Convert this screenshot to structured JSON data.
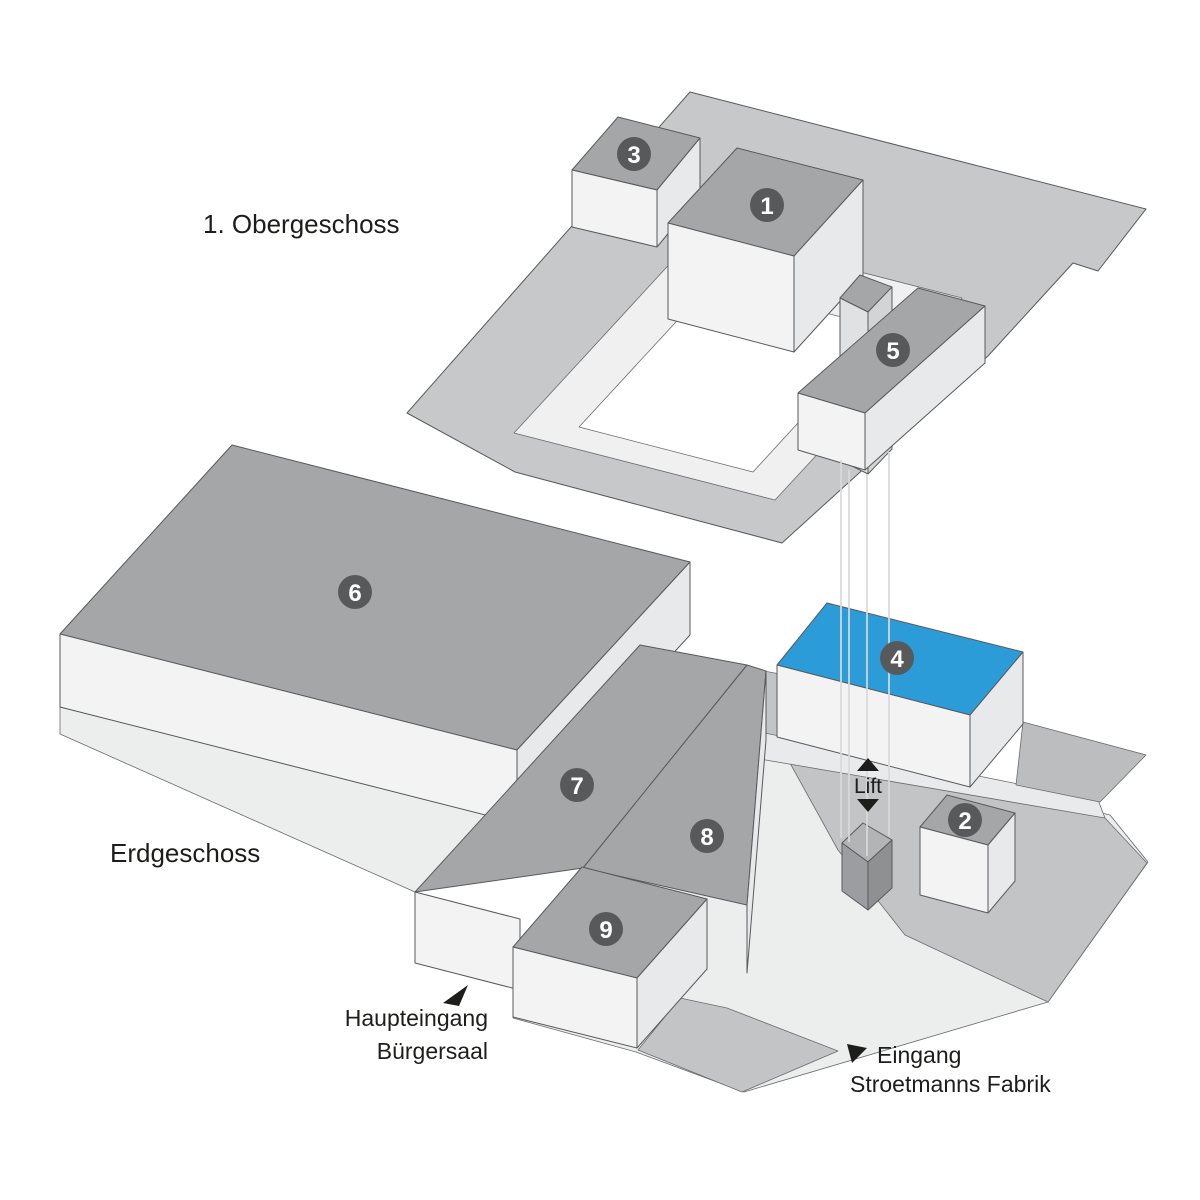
{
  "floors": {
    "upper": {
      "label": "1. Obergeschoss"
    },
    "ground": {
      "label": "Erdgeschoss"
    }
  },
  "sections": [
    {
      "number": "1",
      "floor": "upper"
    },
    {
      "number": "2",
      "floor": "ground"
    },
    {
      "number": "3",
      "floor": "upper"
    },
    {
      "number": "4",
      "floor": "ground",
      "highlighted": true
    },
    {
      "number": "5",
      "floor": "upper"
    },
    {
      "number": "6",
      "floor": "ground"
    },
    {
      "number": "7",
      "floor": "ground"
    },
    {
      "number": "8",
      "floor": "ground"
    },
    {
      "number": "9",
      "floor": "ground"
    }
  ],
  "highlighted_section": "4",
  "lift": {
    "label": "Lift"
  },
  "entrances": {
    "main": {
      "line1": "Haupteingang",
      "line2": "Bürgersaal"
    },
    "fabrik": {
      "line1": "Eingang",
      "line2": "Stroetmanns Fabrik"
    }
  },
  "colors": {
    "highlight": "#2b9cd8",
    "roof": "#a4a6a8",
    "face_left": "#f3f3f4",
    "face_right": "#e8e9ea",
    "plate": "#c7c8ca",
    "ring": "#f0f0f1",
    "courtyard": "#ffffff",
    "ground_light": "#eceded",
    "street": "#c3c4c6",
    "terrace": "#bcbdbf",
    "walkway": "#e9eaeb",
    "tower_left": "#e0e1e2",
    "tower_right": "#d3d4d5",
    "shaft_top": "#b3b4b6",
    "shaft_left": "#9b9da0",
    "shaft_right": "#8e9092",
    "badge": "#58595b",
    "badge_text": "#ffffff",
    "text": "#1d1d1b",
    "lift_line": "#d9dadb"
  }
}
